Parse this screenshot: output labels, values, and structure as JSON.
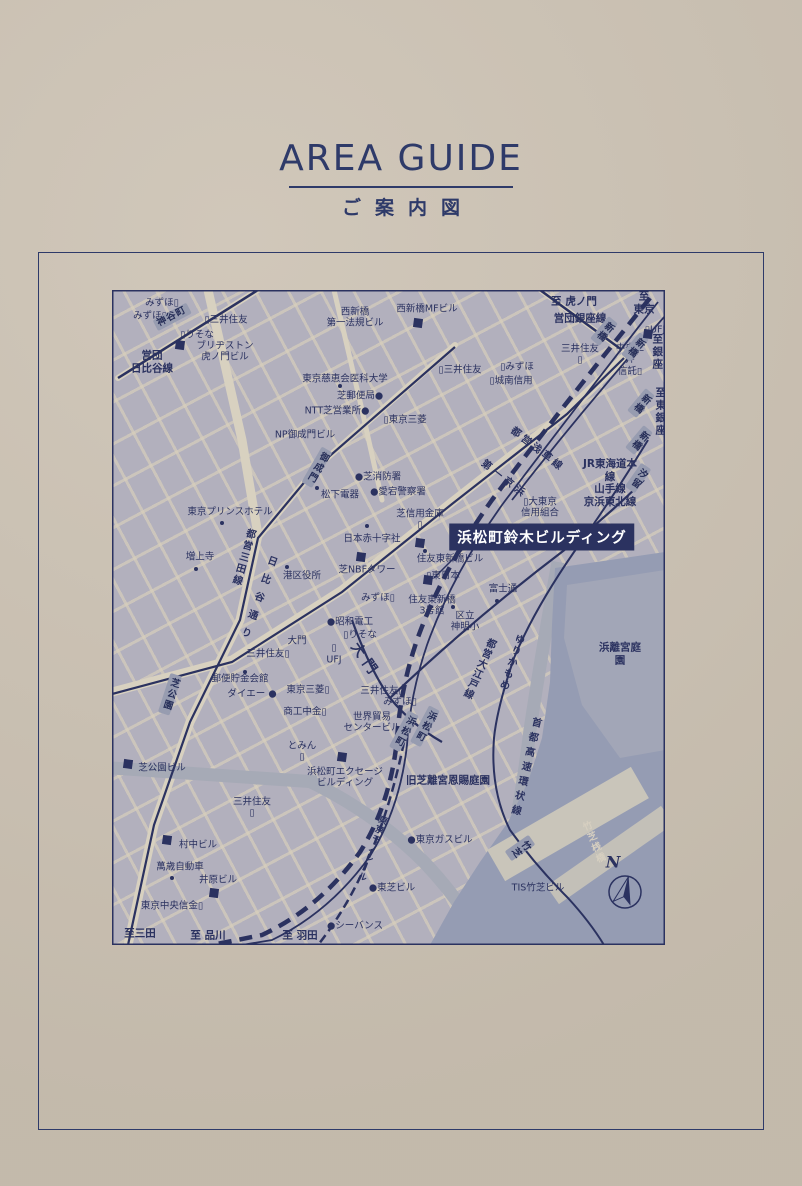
{
  "page": {
    "title": "AREA GUIDE",
    "subtitle": "ご案内図"
  },
  "colors": {
    "paper": "#cbc1b2",
    "ink": "#2e3a69",
    "map_land": "#b2b0bd",
    "road_cream": "#d8d1c0",
    "water": "#959cb3",
    "park": "#a2a6b7",
    "station_box": "#979cb0",
    "highlight_bg": "#2b3260",
    "highlight_text": "#ffffff"
  },
  "map": {
    "highlight": {
      "text": "浜松町鈴木ビルディング"
    },
    "compass": {
      "letter": "N"
    },
    "labels": [
      {
        "t": "みずほ▯",
        "x": 50,
        "y": 13
      },
      {
        "t": "みずほ▯",
        "x": 38,
        "y": 26
      },
      {
        "t": "▯三井住友",
        "x": 114,
        "y": 30
      },
      {
        "t": "▯りそな",
        "x": 85,
        "y": 45
      },
      {
        "t": "ブリヂストン\n虎ノ門ビル",
        "x": 113,
        "y": 62
      },
      {
        "t": "営団\n日比谷線",
        "x": 40,
        "y": 72,
        "c": "b"
      },
      {
        "t": "神谷町",
        "x": 60,
        "y": 27,
        "c": "st",
        "r": -28
      },
      {
        "t": "西新橋MFビル",
        "x": 315,
        "y": 19
      },
      {
        "t": "西新橋\n第一法規ビル",
        "x": 243,
        "y": 28
      },
      {
        "t": "至 虎ノ門",
        "x": 462,
        "y": 12,
        "c": "dest"
      },
      {
        "t": "営団銀座線",
        "x": 468,
        "y": 29,
        "c": "b"
      },
      {
        "t": "至 東京",
        "x": 532,
        "y": 13,
        "c": "dest"
      },
      {
        "t": "▯UFJ",
        "x": 543,
        "y": 40
      },
      {
        "t": "三井住友\n▯",
        "x": 468,
        "y": 65
      },
      {
        "t": "中央三井\n信託▯",
        "x": 518,
        "y": 70
      },
      {
        "t": "至銀座",
        "x": 545,
        "y": 62,
        "c": "destv"
      },
      {
        "t": "至東銀座",
        "x": 548,
        "y": 122,
        "c": "destv"
      },
      {
        "t": "▯三井住友",
        "x": 348,
        "y": 80
      },
      {
        "t": "▯みずほ",
        "x": 405,
        "y": 77
      },
      {
        "t": "▯城南信用",
        "x": 399,
        "y": 91
      },
      {
        "t": "▯東京三菱",
        "x": 293,
        "y": 130
      },
      {
        "t": "東京慈恵会医科大学",
        "x": 233,
        "y": 89
      },
      {
        "t": "芝郵便局●",
        "x": 248,
        "y": 106
      },
      {
        "t": "NTT芝営業所●",
        "x": 225,
        "y": 121
      },
      {
        "t": "NP御成門ビル",
        "x": 193,
        "y": 145
      },
      {
        "t": "御成門",
        "x": 205,
        "y": 177,
        "c": "stv",
        "r": 30
      },
      {
        "t": "新橋",
        "x": 492,
        "y": 41,
        "c": "stv",
        "r": 40
      },
      {
        "t": "新橋",
        "x": 523,
        "y": 57,
        "c": "stv",
        "r": 40
      },
      {
        "t": "新橋",
        "x": 529,
        "y": 113,
        "c": "stv",
        "r": 40
      },
      {
        "t": "新橋",
        "x": 527,
        "y": 150,
        "c": "stv",
        "r": 40
      },
      {
        "t": "汐留",
        "x": 526,
        "y": 188,
        "c": "stv",
        "r": 35
      },
      {
        "t": "JR東海道本線\n山手線\n京浜東北線",
        "x": 498,
        "y": 193,
        "c": "b"
      },
      {
        "t": "都営浅草線",
        "x": 425,
        "y": 160,
        "c": "road",
        "r": 38,
        "ls": 3
      },
      {
        "t": "第一京浜",
        "x": 392,
        "y": 190,
        "c": "road",
        "r": 38,
        "ls": 4
      },
      {
        "t": "東京プリンスホテル",
        "x": 118,
        "y": 222
      },
      {
        "t": "増上寺",
        "x": 88,
        "y": 267
      },
      {
        "t": "港区役所",
        "x": 190,
        "y": 286
      },
      {
        "t": "松下電器",
        "x": 228,
        "y": 205
      },
      {
        "t": "●芝消防署",
        "x": 266,
        "y": 187
      },
      {
        "t": "●愛宕警察署",
        "x": 286,
        "y": 202
      },
      {
        "t": "芝信用金庫\n▯",
        "x": 308,
        "y": 230
      },
      {
        "t": "▯大東京\n信用組合",
        "x": 428,
        "y": 218
      },
      {
        "t": "日本赤十字社",
        "x": 260,
        "y": 249
      },
      {
        "t": "芝NBFタワー",
        "x": 255,
        "y": 280
      },
      {
        "t": "住友東新橋ビル",
        "x": 338,
        "y": 269
      },
      {
        "t": "▯東日本",
        "x": 331,
        "y": 286
      },
      {
        "t": "みずほ▯",
        "x": 266,
        "y": 308
      },
      {
        "t": "住友東新橋\n3号館",
        "x": 320,
        "y": 316
      },
      {
        "t": "富士通",
        "x": 391,
        "y": 299
      },
      {
        "t": "区立\n神明小",
        "x": 353,
        "y": 332
      },
      {
        "t": "●昭和電工",
        "x": 238,
        "y": 332
      },
      {
        "t": "▯りそな",
        "x": 248,
        "y": 345
      },
      {
        "t": "大門",
        "x": 185,
        "y": 351
      },
      {
        "t": "▯",
        "x": 222,
        "y": 358
      },
      {
        "t": "UFJ",
        "x": 222,
        "y": 370
      },
      {
        "t": "三井住友▯",
        "x": 156,
        "y": 364
      },
      {
        "t": "郵便貯金会館",
        "x": 128,
        "y": 389
      },
      {
        "t": "ダイエー ●",
        "x": 140,
        "y": 404
      },
      {
        "t": "東京三菱▯",
        "x": 196,
        "y": 400
      },
      {
        "t": "商工中金▯",
        "x": 193,
        "y": 422
      },
      {
        "t": "世界貿易\nセンタービル",
        "x": 260,
        "y": 433
      },
      {
        "t": "三井住友▯",
        "x": 270,
        "y": 401
      },
      {
        "t": "みずほ▯",
        "x": 288,
        "y": 412
      },
      {
        "t": "大門",
        "x": 253,
        "y": 371,
        "c": "road",
        "r": 55,
        "fs": 14,
        "ls": 6
      },
      {
        "t": "都営三田線",
        "x": 130,
        "y": 267,
        "c": "roadv",
        "r": 16,
        "ls": 2
      },
      {
        "t": "日比谷通り",
        "x": 144,
        "y": 310,
        "c": "roadv",
        "r": 20,
        "ls": 9
      },
      {
        "t": "芝公園",
        "x": 58,
        "y": 404,
        "c": "stv",
        "r": 18
      },
      {
        "t": "とみん\n▯",
        "x": 190,
        "y": 462
      },
      {
        "t": "芝公園ビル",
        "x": 50,
        "y": 478
      },
      {
        "t": "浜松町エクセージ\nビルディング",
        "x": 233,
        "y": 488
      },
      {
        "t": "旧芝離宮恩賜庭園",
        "x": 336,
        "y": 491,
        "c": "b"
      },
      {
        "t": "浜離宮庭園",
        "x": 508,
        "y": 364,
        "c": "b"
      },
      {
        "t": "都営大江戸線",
        "x": 366,
        "y": 378,
        "c": "roadv",
        "r": 24,
        "ls": 1
      },
      {
        "t": "ゆりかもめ",
        "x": 398,
        "y": 372,
        "c": "roadv",
        "r": 18,
        "ls": 2
      },
      {
        "t": "首都高速環状線",
        "x": 412,
        "y": 478,
        "c": "roadv",
        "r": 13,
        "ls": 5
      },
      {
        "t": "東京モノレール",
        "x": 259,
        "y": 558,
        "c": "roadv",
        "r": 20,
        "ls": 1,
        "fs": 9
      },
      {
        "t": "浜松町",
        "x": 292,
        "y": 441,
        "c": "stv",
        "r": 28
      },
      {
        "t": "浜松町",
        "x": 313,
        "y": 436,
        "c": "stv",
        "r": 28
      },
      {
        "t": "竹芝",
        "x": 408,
        "y": 558,
        "c": "stv",
        "r": 55
      },
      {
        "t": "竹芝桟橋",
        "x": 481,
        "y": 553,
        "c": "palev",
        "r": -22,
        "ls": 2
      },
      {
        "t": "TIS竹芝ビル",
        "x": 426,
        "y": 598
      },
      {
        "t": "●東京ガスビル",
        "x": 328,
        "y": 550
      },
      {
        "t": "●東芝ビル",
        "x": 280,
        "y": 598
      },
      {
        "t": "●シーバンス",
        "x": 243,
        "y": 636
      },
      {
        "t": "至三田",
        "x": 28,
        "y": 644,
        "c": "dest"
      },
      {
        "t": "至 品川",
        "x": 96,
        "y": 646,
        "c": "dest"
      },
      {
        "t": "至 羽田",
        "x": 188,
        "y": 646,
        "c": "dest"
      },
      {
        "t": "村中ビル",
        "x": 86,
        "y": 555
      },
      {
        "t": "萬歳自動車",
        "x": 68,
        "y": 577
      },
      {
        "t": "井原ビル",
        "x": 106,
        "y": 590
      },
      {
        "t": "東京中央信金▯",
        "x": 60,
        "y": 616
      },
      {
        "t": "三井住友\n▯",
        "x": 140,
        "y": 518
      },
      {
        "t": "N",
        "x": 501,
        "y": 572,
        "c": "north"
      }
    ],
    "dots": [
      [
        228,
        96
      ],
      [
        110,
        233
      ],
      [
        84,
        279
      ],
      [
        175,
        277
      ],
      [
        205,
        198
      ],
      [
        255,
        236
      ],
      [
        385,
        311
      ],
      [
        133,
        382
      ],
      [
        60,
        588
      ],
      [
        341,
        317
      ],
      [
        313,
        261
      ]
    ],
    "squares": [
      [
        68,
        55
      ],
      [
        306,
        33
      ],
      [
        249,
        267
      ],
      [
        308,
        253
      ],
      [
        16,
        474
      ],
      [
        230,
        467
      ],
      [
        55,
        550
      ],
      [
        102,
        603
      ],
      [
        316,
        290
      ],
      [
        536,
        44
      ]
    ]
  }
}
